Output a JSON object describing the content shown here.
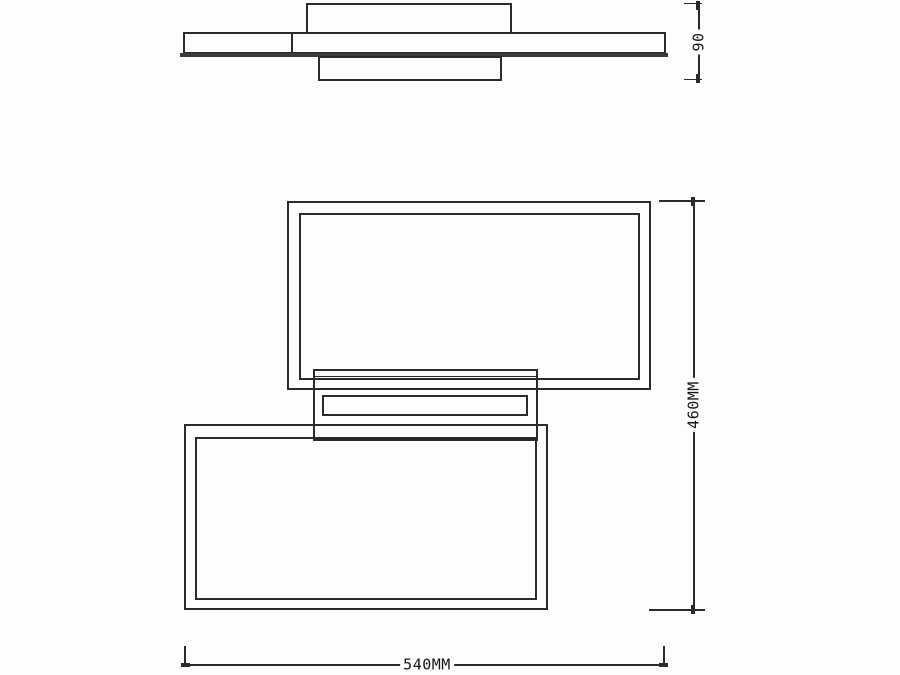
{
  "drawing": {
    "background": "#fdfdfd",
    "line_color": "#2b2b2b",
    "dimensions": {
      "profile_height": {
        "label": "90"
      },
      "overall_height": {
        "label": "460MM"
      },
      "overall_width": {
        "label": "540MM"
      }
    }
  }
}
